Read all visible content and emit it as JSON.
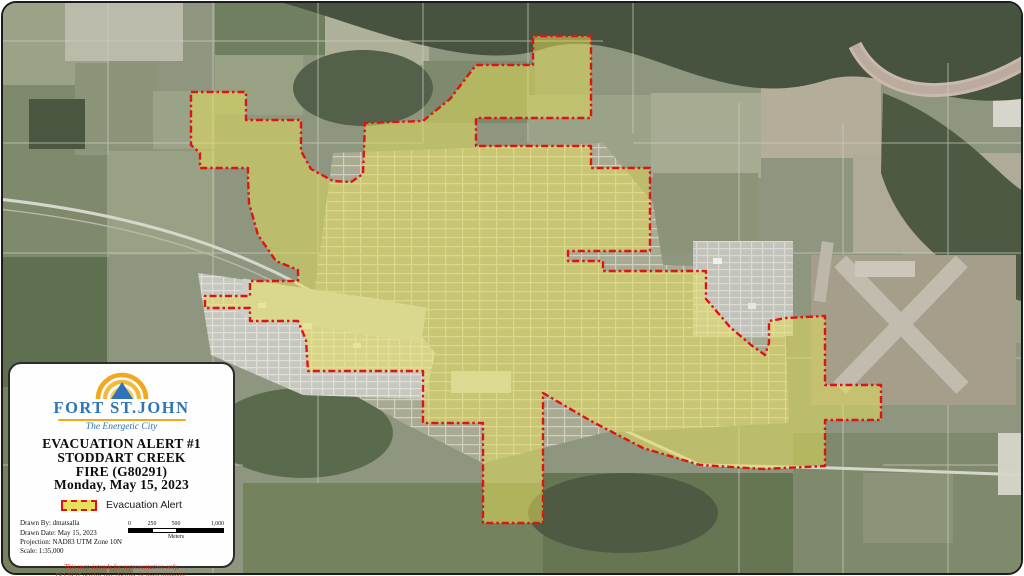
{
  "map": {
    "evacuation_zone": {
      "label": "Evacuation Alert area boundary",
      "points": [
        [
          188,
          89
        ],
        [
          243,
          89
        ],
        [
          243,
          117
        ],
        [
          298,
          117
        ],
        [
          298,
          148
        ],
        [
          308,
          166
        ],
        [
          330,
          178
        ],
        [
          348,
          179
        ],
        [
          360,
          171
        ],
        [
          362,
          120
        ],
        [
          420,
          118
        ],
        [
          447,
          96
        ],
        [
          473,
          62
        ],
        [
          530,
          62
        ],
        [
          530,
          33
        ],
        [
          588,
          33
        ],
        [
          588,
          115
        ],
        [
          473,
          115
        ],
        [
          473,
          143
        ],
        [
          588,
          143
        ],
        [
          588,
          165
        ],
        [
          647,
          165
        ],
        [
          647,
          248
        ],
        [
          565,
          248
        ],
        [
          565,
          258
        ],
        [
          600,
          258
        ],
        [
          600,
          268
        ],
        [
          703,
          268
        ],
        [
          703,
          296
        ],
        [
          727,
          324
        ],
        [
          748,
          342
        ],
        [
          762,
          352
        ],
        [
          766,
          340
        ],
        [
          766,
          318
        ],
        [
          783,
          315
        ],
        [
          822,
          313
        ],
        [
          822,
          382
        ],
        [
          878,
          382
        ],
        [
          878,
          417
        ],
        [
          822,
          417
        ],
        [
          822,
          463
        ],
        [
          760,
          466
        ],
        [
          697,
          462
        ],
        [
          640,
          445
        ],
        [
          588,
          418
        ],
        [
          540,
          390
        ],
        [
          540,
          520
        ],
        [
          480,
          520
        ],
        [
          480,
          420
        ],
        [
          420,
          420
        ],
        [
          420,
          368
        ],
        [
          305,
          368
        ],
        [
          303,
          337
        ],
        [
          295,
          318
        ],
        [
          247,
          318
        ],
        [
          247,
          305
        ],
        [
          202,
          305
        ],
        [
          202,
          293
        ],
        [
          247,
          293
        ],
        [
          247,
          278
        ],
        [
          295,
          278
        ],
        [
          295,
          267
        ],
        [
          273,
          258
        ],
        [
          255,
          232
        ],
        [
          246,
          200
        ],
        [
          245,
          175
        ],
        [
          245,
          165
        ],
        [
          197,
          165
        ],
        [
          197,
          150
        ],
        [
          188,
          142
        ]
      ]
    },
    "colors": {
      "zone_fill": "#e7e05a",
      "zone_border": "#e01313",
      "logo_blue": "#2f74b8",
      "logo_gold": "#f0a91d",
      "disclaimer_red": "#d93025"
    }
  },
  "info_box": {
    "logo": {
      "city_name": "FORT ST.JOHN",
      "tagline": "The Energetic City"
    },
    "title_lines": [
      "EVACUATION ALERT #1",
      "STODDART CREEK",
      "FIRE (G80291)",
      "Monday, May 15, 2023"
    ],
    "legend": {
      "label": "Evacuation Alert"
    },
    "credits": [
      "Drawn By: dmatsalla",
      "Drawn Date: May 15, 2023",
      "Projection: NAD83 UTM Zone 10N",
      "Scale:  1:35,000"
    ],
    "scale_bar": {
      "ticks": [
        "0",
        "250",
        "500",
        "1,000"
      ],
      "unit": "Meters"
    },
    "disclaimer_lines": [
      "This map intends for representation only.",
      "DO NOT use for any designs or measurements."
    ]
  }
}
